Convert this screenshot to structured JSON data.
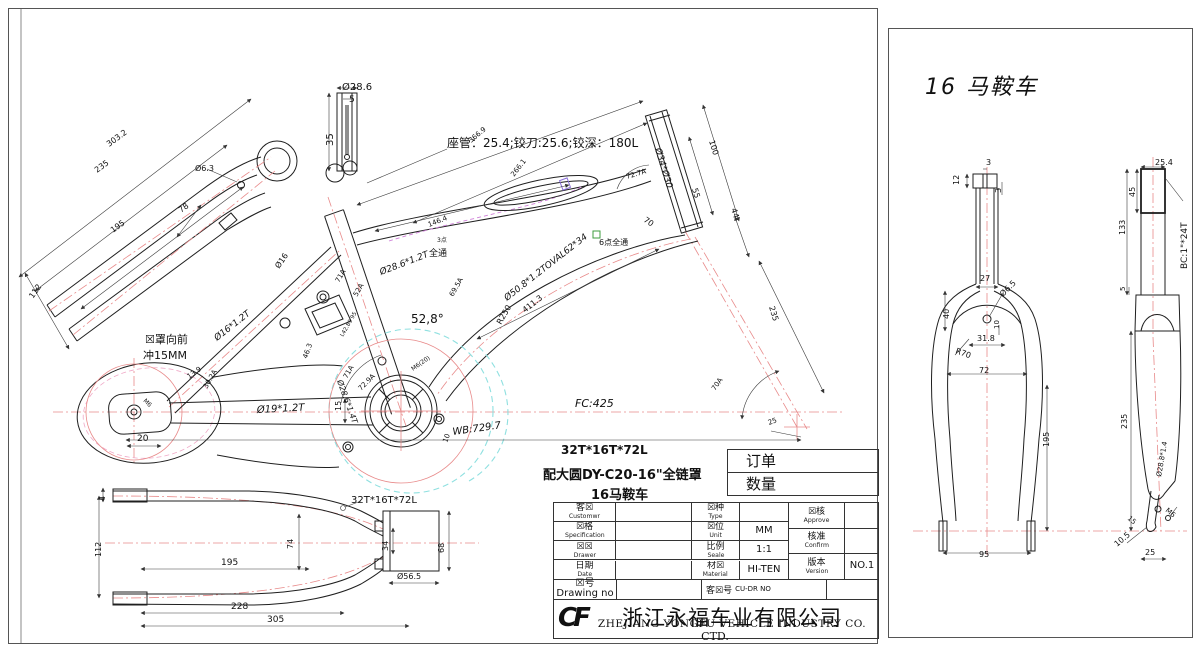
{
  "colors": {
    "outline": "#1f1f1f",
    "centerline": "#e88a8a",
    "chaincase_cyan": "#8fe0e0",
    "pink": "#f0aac8",
    "magenta": "#cf7fd8",
    "green": "#3f9e3f"
  },
  "sheet": {
    "order_label": "订单",
    "qty_label": "数量",
    "spec_lines": [
      "32T*16T*72L",
      "配大圆DY-C20-16\"全链罩",
      "16马鞍车"
    ],
    "title_block": {
      "customer": {
        "cn": "客☒",
        "en": "Customwr",
        "val": ""
      },
      "spec": {
        "cn": "☒格",
        "en": "Specification",
        "val": ""
      },
      "drawer": {
        "cn": "☒☒",
        "en": "Drawer",
        "val": ""
      },
      "date": {
        "cn": "日期",
        "en": "Date",
        "val": ""
      },
      "type": {
        "cn": "☒种",
        "en": "Type",
        "val": ""
      },
      "unit": {
        "cn": "☒位",
        "en": "Unit",
        "val": "MM"
      },
      "scale": {
        "cn": "比例",
        "en": "Seale",
        "val": "1:1"
      },
      "material": {
        "cn": "材☒",
        "en": "Material",
        "val": "HI-TEN"
      },
      "approve": {
        "cn": "☒核",
        "en": "Approve",
        "val": ""
      },
      "confirm": {
        "cn": "核准",
        "en": "Confirm",
        "val": ""
      },
      "version": {
        "cn": "版本",
        "en": "Version",
        "val": "NO.1"
      },
      "drawing_no": {
        "cn": "☒号",
        "en": "Drawing no",
        "val": ""
      },
      "cu_dr": {
        "cn": "客☒号",
        "en": "CU-DR NO"
      }
    },
    "company": {
      "logo": "CF",
      "cn": "浙江永福车业有限公司",
      "en": "ZHEJIANG YONGFU VEHICLE INDUSTRY CO.",
      "sub": "CTD."
    }
  },
  "right_panel": {
    "title": "16 马鞍车"
  },
  "drawing": {
    "main_labels": [
      {
        "t": "Ø28.6",
        "x": 333,
        "y": 81,
        "fs": 10
      },
      {
        "t": "5",
        "x": 340,
        "y": 93,
        "fs": 9
      },
      {
        "t": "35",
        "x": 324,
        "y": 137,
        "fs": 10,
        "r": -90
      },
      {
        "t": "座管：25.4;铰刀:25.6;铰深：180L",
        "x": 438,
        "y": 138,
        "fs": 12
      },
      {
        "t": "366.9",
        "x": 462,
        "y": 134,
        "fs": 7,
        "r": -40
      },
      {
        "t": "266.1",
        "x": 505,
        "y": 168,
        "fs": 7,
        "r": -52
      },
      {
        "t": "146.4",
        "x": 420,
        "y": 218,
        "fs": 7,
        "r": -21
      },
      {
        "t": "3点",
        "x": 428,
        "y": 233,
        "fs": 6
      },
      {
        "t": "全通",
        "x": 420,
        "y": 247,
        "fs": 9
      },
      {
        "t": "Ø28.6*1.2T",
        "x": 372,
        "y": 266,
        "fs": 9,
        "r": -21,
        "it": 1
      },
      {
        "t": "Ø34*Ø30",
        "x": 646,
        "y": 140,
        "fs": 9,
        "r": 73,
        "it": 1
      },
      {
        "t": "100",
        "x": 700,
        "y": 132,
        "fs": 8,
        "r": 73
      },
      {
        "t": "55",
        "x": 683,
        "y": 180,
        "fs": 8,
        "r": 73
      },
      {
        "t": "44",
        "x": 722,
        "y": 200,
        "fs": 8,
        "r": 73
      },
      {
        "t": "72.7A",
        "x": 618,
        "y": 170,
        "fs": 7,
        "r": -17
      },
      {
        "t": "70",
        "x": 634,
        "y": 212,
        "fs": 8,
        "r": 35
      },
      {
        "t": "235",
        "x": 760,
        "y": 298,
        "fs": 8,
        "r": 73
      },
      {
        "t": "70A",
        "x": 706,
        "y": 382,
        "fs": 7,
        "r": -55
      },
      {
        "t": "25",
        "x": 760,
        "y": 416,
        "fs": 7,
        "r": -20
      },
      {
        "t": "FC:425",
        "x": 566,
        "y": 398,
        "fs": 11,
        "it": 1
      },
      {
        "t": "WB:729.7",
        "x": 444,
        "y": 426,
        "fs": 10,
        "it": 1,
        "r": -8
      },
      {
        "t": "Ø50.8*1.2TOVAL62*34",
        "x": 498,
        "y": 292,
        "fs": 9,
        "r": -38,
        "it": 1
      },
      {
        "t": "411.3",
        "x": 516,
        "y": 304,
        "fs": 8,
        "r": -38
      },
      {
        "t": "R250",
        "x": 492,
        "y": 316,
        "fs": 8,
        "r": -60
      },
      {
        "t": "6点全通",
        "x": 590,
        "y": 236,
        "fs": 8
      },
      {
        "t": "52,8°",
        "x": 402,
        "y": 314,
        "fs": 12
      },
      {
        "t": "69.5A",
        "x": 444,
        "y": 288,
        "fs": 7,
        "r": -60
      },
      {
        "t": "Ø28.6*1.4T",
        "x": 328,
        "y": 372,
        "fs": 8,
        "r": 70,
        "it": 1
      },
      {
        "t": "71A",
        "x": 330,
        "y": 274,
        "fs": 7,
        "r": -60
      },
      {
        "t": "52A",
        "x": 348,
        "y": 288,
        "fs": 7,
        "r": -60
      },
      {
        "t": "L42.89 95",
        "x": 334,
        "y": 328,
        "fs": 5.5,
        "r": -60
      },
      {
        "t": "71A",
        "x": 338,
        "y": 370,
        "fs": 7,
        "r": -60
      },
      {
        "t": "72.9A",
        "x": 352,
        "y": 382,
        "fs": 7,
        "r": -45
      },
      {
        "t": "M6(20)",
        "x": 404,
        "y": 362,
        "fs": 6,
        "r": -35
      },
      {
        "t": "10",
        "x": 438,
        "y": 434,
        "fs": 7,
        "r": -70
      },
      {
        "t": "15",
        "x": 332,
        "y": 402,
        "fs": 8,
        "r": -90
      },
      {
        "t": "M6",
        "x": 134,
        "y": 392,
        "fs": 6,
        "r": 45
      },
      {
        "t": "20",
        "x": 128,
        "y": 432,
        "fs": 9
      },
      {
        "t": "13.9",
        "x": 180,
        "y": 370,
        "fs": 7,
        "r": -35
      },
      {
        "t": "30.2A",
        "x": 198,
        "y": 380,
        "fs": 7,
        "r": -60
      },
      {
        "t": "Ø19*1.2T",
        "x": 248,
        "y": 404,
        "fs": 10,
        "it": 1,
        "r": -3
      },
      {
        "t": "46.3",
        "x": 298,
        "y": 350,
        "fs": 7,
        "r": -70
      },
      {
        "t": "Ø16*1.2T",
        "x": 208,
        "y": 332,
        "fs": 9,
        "r": -38,
        "it": 1
      },
      {
        "t": "Ø16",
        "x": 270,
        "y": 260,
        "fs": 8,
        "r": -55
      },
      {
        "t": "☒罩向前",
        "x": 136,
        "y": 334,
        "fs": 11
      },
      {
        "t": "冲15MM",
        "x": 134,
        "y": 350,
        "fs": 11
      },
      {
        "t": "303.2",
        "x": 100,
        "y": 138,
        "fs": 8,
        "r": -36
      },
      {
        "t": "235",
        "x": 88,
        "y": 164,
        "fs": 8,
        "r": -36
      },
      {
        "t": "195",
        "x": 104,
        "y": 224,
        "fs": 8,
        "r": -36
      },
      {
        "t": "78",
        "x": 172,
        "y": 204,
        "fs": 8,
        "r": -36
      },
      {
        "t": "Ø6.3",
        "x": 186,
        "y": 162,
        "fs": 8
      },
      {
        "t": "112",
        "x": 24,
        "y": 290,
        "fs": 8,
        "r": -55
      },
      {
        "t": "32T*16T*72L",
        "x": 342,
        "y": 494,
        "fs": 10
      },
      {
        "t": "4",
        "x": 96,
        "y": 492,
        "fs": 8,
        "r": -90
      },
      {
        "t": "112",
        "x": 92,
        "y": 548,
        "fs": 8,
        "r": -90
      },
      {
        "t": "195",
        "x": 212,
        "y": 556,
        "fs": 9
      },
      {
        "t": "74",
        "x": 284,
        "y": 540,
        "fs": 8,
        "r": -90
      },
      {
        "t": "228",
        "x": 222,
        "y": 600,
        "fs": 9
      },
      {
        "t": "305",
        "x": 258,
        "y": 613,
        "fs": 9
      },
      {
        "t": "34",
        "x": 379,
        "y": 542,
        "fs": 8,
        "r": -90
      },
      {
        "t": "68",
        "x": 435,
        "y": 544,
        "fs": 8,
        "r": -90
      },
      {
        "t": "Ø56.5",
        "x": 388,
        "y": 570,
        "fs": 8
      }
    ],
    "fork_labels": [
      {
        "t": "3",
        "x": 97,
        "y": 136,
        "fs": 8
      },
      {
        "t": "12",
        "x": 70,
        "y": 156,
        "fs": 8,
        "r": -90
      },
      {
        "t": "3",
        "x": 112,
        "y": 164,
        "fs": 8,
        "r": -90
      },
      {
        "t": "27",
        "x": 91,
        "y": 252,
        "fs": 8
      },
      {
        "t": "40",
        "x": 60,
        "y": 290,
        "fs": 8,
        "r": -90
      },
      {
        "t": "Ø6.5",
        "x": 114,
        "y": 268,
        "fs": 8,
        "r": -45
      },
      {
        "t": "10",
        "x": 110,
        "y": 300,
        "fs": 7,
        "r": -90
      },
      {
        "t": "31.8",
        "x": 88,
        "y": 312,
        "fs": 8
      },
      {
        "t": "R70",
        "x": 66,
        "y": 324,
        "fs": 8,
        "r": 20
      },
      {
        "t": "72",
        "x": 90,
        "y": 344,
        "fs": 8
      },
      {
        "t": "195",
        "x": 160,
        "y": 418,
        "fs": 8,
        "r": -90
      },
      {
        "t": "95",
        "x": 90,
        "y": 528,
        "fs": 8
      },
      {
        "t": "25.4",
        "x": 266,
        "y": 136,
        "fs": 8
      },
      {
        "t": "45",
        "x": 246,
        "y": 168,
        "fs": 8,
        "r": -90
      },
      {
        "t": "133",
        "x": 236,
        "y": 206,
        "fs": 8,
        "r": -90
      },
      {
        "t": "BC:1\"*24T",
        "x": 298,
        "y": 240,
        "fs": 9,
        "r": -90
      },
      {
        "t": "5",
        "x": 236,
        "y": 262,
        "fs": 7,
        "r": -90
      },
      {
        "t": "235",
        "x": 238,
        "y": 400,
        "fs": 8,
        "r": -90
      },
      {
        "t": "Ø28.8*1.4",
        "x": 272,
        "y": 448,
        "fs": 7,
        "r": -80
      },
      {
        "t": "15",
        "x": 238,
        "y": 490,
        "fs": 7,
        "r": 40
      },
      {
        "t": "M6",
        "x": 276,
        "y": 482,
        "fs": 7,
        "r": 40
      },
      {
        "t": "10.5",
        "x": 228,
        "y": 518,
        "fs": 8,
        "r": -40
      },
      {
        "t": "25",
        "x": 256,
        "y": 526,
        "fs": 8
      }
    ]
  }
}
